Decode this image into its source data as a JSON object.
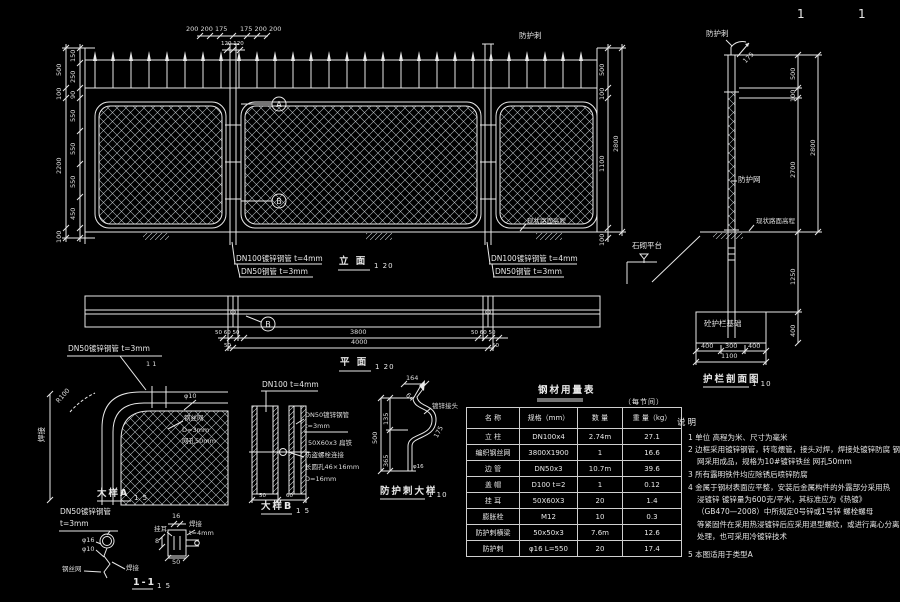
{
  "page": {
    "sheet_left": "1",
    "sheet_right": "1"
  },
  "colors": {
    "background": "#000000",
    "line": "#e8e8e8",
    "dim_text": "#dcdcdc"
  },
  "elevation": {
    "title": "立 面",
    "scale": "1 20",
    "spike_label": "防护刺",
    "ground_label": "现状路面高程",
    "callout_a": "A",
    "callout_b": "B",
    "dim_top_left": "200 200 175",
    "dim_top_right": "175 200 200",
    "dim_top_center": "120 120",
    "dims_left_outer": [
      "500",
      "100",
      "2200",
      "100"
    ],
    "dims_left_inner": [
      "150",
      "250",
      "90",
      "550",
      "550",
      "550",
      "450"
    ],
    "dims_right": [
      "500",
      "100",
      "1100",
      "2800",
      "100"
    ],
    "pipe_label_dn100": "DN100镀锌钢管 t=4mm",
    "pipe_label_dn50": "DN50钢管 t=3mm"
  },
  "plan": {
    "title": "平 面",
    "scale": "1 20",
    "callout_b": "B",
    "dim_post_left": "50 60 50",
    "dim_post_right": "50 60 50",
    "dim_mid": "3800",
    "dim_total": "4000",
    "dim_small_left": "50",
    "dim_small_right": "50"
  },
  "detail_a": {
    "title": "大样A",
    "scale": "1 5",
    "pipe_label": "DN50镀锌钢管 t=3mm",
    "section_marks": "1  1",
    "radius": "R100",
    "weld": "焊接",
    "wire_dia": "φ10",
    "mesh_line1": "钢丝网",
    "mesh_line2": "D=3mm",
    "mesh_line3": "网孔50mm"
  },
  "section_11": {
    "title": "1-1",
    "scale": "1 5",
    "pipe_label_line1": "DN50镀锌钢管",
    "pipe_label_line2": "t=3mm",
    "dia16": "φ16",
    "dia10": "φ10",
    "mesh": "钢丝网",
    "weld_left": "焊接",
    "lug": "挂耳",
    "dim_16": "16",
    "weld_right": "焊接",
    "weld_thick": "t=4mm",
    "dim_8": "8",
    "dim_50": "50"
  },
  "detail_b": {
    "title": "大样B",
    "scale": "1 5",
    "top_label": "DN100 t=4mm",
    "label_dn50": "DN50镀锌钢管",
    "label_t3": "t=3mm",
    "label_flat": "50X60x3 扁铁",
    "label_bolt": "防盗螺栓连接",
    "label_slot": "长圆孔46×16mm",
    "label_d16": "D=16mm",
    "dim_50": "50",
    "dim_60": "60"
  },
  "spike_detail": {
    "title": "防护刺大样",
    "scale": "1 10",
    "dim_164": "164",
    "dim_64": "64",
    "joint_label": "镀锌接头",
    "dim_135": "135",
    "dim_500": "500",
    "dim_365": "365",
    "dim_175": "175",
    "dim_phi16": "φ16"
  },
  "table": {
    "title": "钢材用量表",
    "subtitle": "（每节间）",
    "headers": [
      "名 称",
      "规格（mm）",
      "数 量",
      "重 量（kg）"
    ],
    "rows": [
      {
        "name": "立 柱",
        "spec": "DN100x4",
        "qty": "2.74m",
        "weight": "27.1"
      },
      {
        "name": "编织钢丝网",
        "spec": "3800X1900",
        "qty": "1",
        "weight": "16.6"
      },
      {
        "name": "边 管",
        "spec": "DN50x3",
        "qty": "10.7m",
        "weight": "39.6"
      },
      {
        "name": "盖 帽",
        "spec": "D100 t=2",
        "qty": "1",
        "weight": "0.12"
      },
      {
        "name": "挂 耳",
        "spec": "50X60X3",
        "qty": "20",
        "weight": "1.4"
      },
      {
        "name": "膨胀栓",
        "spec": "M12",
        "qty": "10",
        "weight": "0.3"
      },
      {
        "name": "防护刺横梁",
        "spec": "50x50x3",
        "qty": "7.6m",
        "weight": "12.6"
      },
      {
        "name": "防护刺",
        "spec": "φ16 L=550",
        "qty": "20",
        "weight": "17.4"
      }
    ]
  },
  "section_view": {
    "title": "护栏剖面图",
    "scale": "1 10",
    "spike_label": "防护刺",
    "mesh_label": "防护网",
    "ground_label": "现状路面高程",
    "platform_label": "石砌平台",
    "foundation_label": "砼护栏基础",
    "dim_arm": "175",
    "dims_right": [
      "500",
      "100",
      "2700",
      "2800",
      "1250",
      "400"
    ],
    "dims_bottom": [
      "400",
      "300",
      "400",
      "1100"
    ]
  },
  "notes": {
    "heading": "说明",
    "lines": [
      "1  单位 高程为米、尺寸为毫米",
      "2  边框采用镀锌钢管，转弯煨管，接头对焊，焊接处镀锌防腐  钢丝",
      "网采用成品，规格为10#镀锌铁丝 网孔50mm",
      "3  所有露明铁件均应除锈后喷锌防腐",
      "4  金属于钢材表面应平整，安装后金属构件的外露部分采用热",
      "浸镀锌  镀锌量为600克/平米，其标准应为《热镀》",
      "（GB470—2008）中所规定0号锌或1号锌  螺栓螺母",
      "等紧固件在采用热浸镀锌后应采用退型螺纹，或进行离心分离",
      "处理，也可采用冷镀锌技术",
      "5  本图适用于类型A"
    ]
  }
}
